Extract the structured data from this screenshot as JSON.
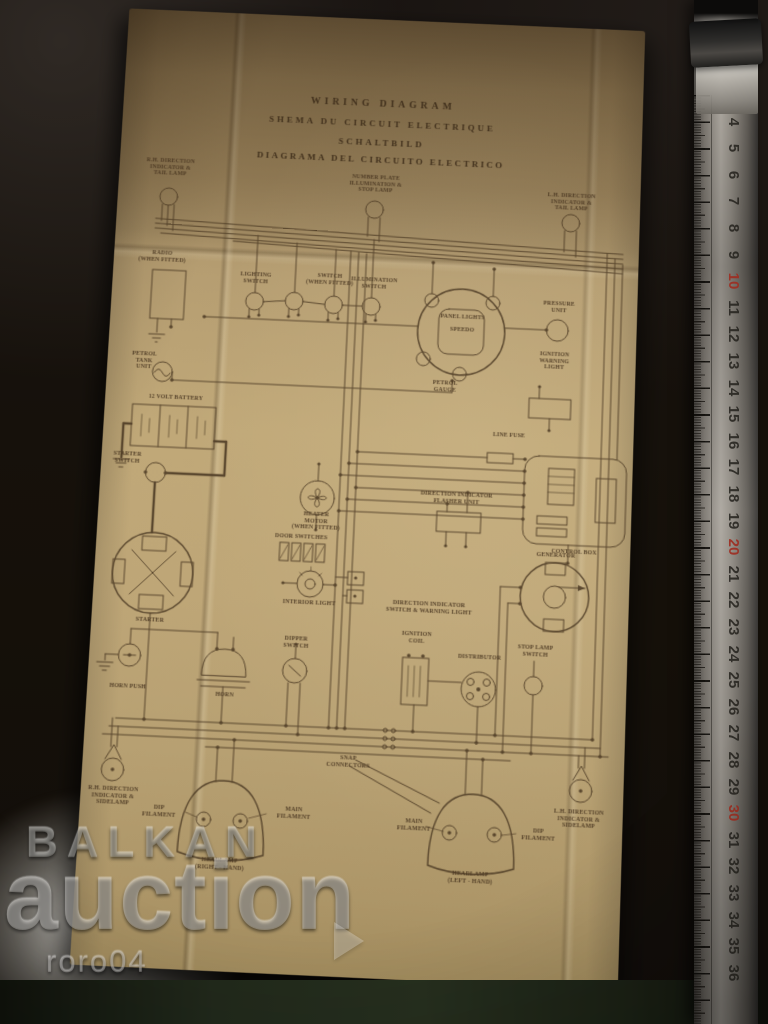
{
  "document": {
    "titles": [
      "WIRING DIAGRAM",
      "SHEMA DU CIRCUIT ELECTRIQUE",
      "SCHALTBILD",
      "DIAGRAMA DEL CIRCUITO ELECTRICO"
    ],
    "labels": {
      "rh_rear_lamp": "R.H. DIRECTION\nINDICATOR &\nTAIL LAMP",
      "number_plate_lamp": "NUMBER PLATE\nILLUMINATION &\nSTOP LAMP",
      "lh_rear_lamp": "L.H. DIRECTION\nINDICATOR &\nTAIL LAMP",
      "radio": "RADIO\n(WHEN FITTED)",
      "lighting_switch": "LIGHTING\nSWITCH",
      "switch_when_fitted": "SWITCH\n(WHEN FITTED)",
      "illumination_switch": "ILLUMINATION\nSWITCH",
      "panel_lights": "PANEL LIGHTS",
      "speedo": "SPEEDO",
      "pressure_unit": "PRESSURE\nUNIT",
      "ignition_warning_light": "IGNITION\nWARNING\nLIGHT",
      "petrol_gauge": "PETROL\nGAUGE",
      "petrol_tank_unit": "PETROL\nTANK\nUNIT",
      "battery": "12 VOLT BATTERY",
      "starter_switch": "STARTER\nSWITCH",
      "line_fuse": "LINE FUSE",
      "flasher_unit": "DIRECTION INDICATOR\nFLASHER UNIT",
      "control_box": "CONTROL BOX",
      "heater_motor": "HEATER\nMOTOR\n(WHEN FITTED)",
      "door_switches": "DOOR SWITCHES",
      "interior_light": "INTERIOR LIGHT",
      "generator": "GENERATOR",
      "di_switch": "DIRECTION INDICATOR\nSWITCH & WARNING LIGHT",
      "starter": "STARTER",
      "horn_push": "HORN PUSH",
      "horn": "HORN",
      "dipper_switch": "DIPPER\nSWITCH",
      "ignition_coil": "IGNITION\nCOIL",
      "distributor": "DISTRIBUTOR",
      "stop_lamp_switch": "STOP LAMP\nSWITCH",
      "snap_connectors": "SNAP\nCONNECTORS",
      "rh_front_lamp": "R.H. DIRECTION\nINDICATOR &\nSIDELAMP",
      "dip_filament_r": "DIP\nFILAMENT",
      "main_filament_r": "MAIN\nFILAMENT",
      "headlamp_rh": "HEADLAMP\n(RIGHT - HAND)",
      "main_filament_l": "MAIN\nFILAMENT",
      "dip_filament_l": "DIP\nFILAMENT",
      "headlamp_lh": "HEADLAMP\n(LEFT - HAND)",
      "lh_front_lamp": "L.H. DIRECTION\nINDICATOR &\nSIDELAMP"
    },
    "paper_color": "#bfa877",
    "ink_color": "#4c3a24"
  },
  "watermark": {
    "brand_top": "BALKAN",
    "brand_main": "auction",
    "username": "roro04",
    "play_icon": "right-triangle"
  },
  "ruler": {
    "numbers": [
      4,
      5,
      6,
      7,
      8,
      9,
      10,
      11,
      12,
      13,
      14,
      15,
      16,
      17,
      18,
      19,
      20,
      21,
      22,
      23,
      24,
      25,
      26,
      27,
      28,
      29,
      30,
      31,
      32,
      33,
      34,
      35,
      36
    ],
    "red_numbers": [
      10,
      20,
      30
    ],
    "red_color": "#9e2e22"
  }
}
